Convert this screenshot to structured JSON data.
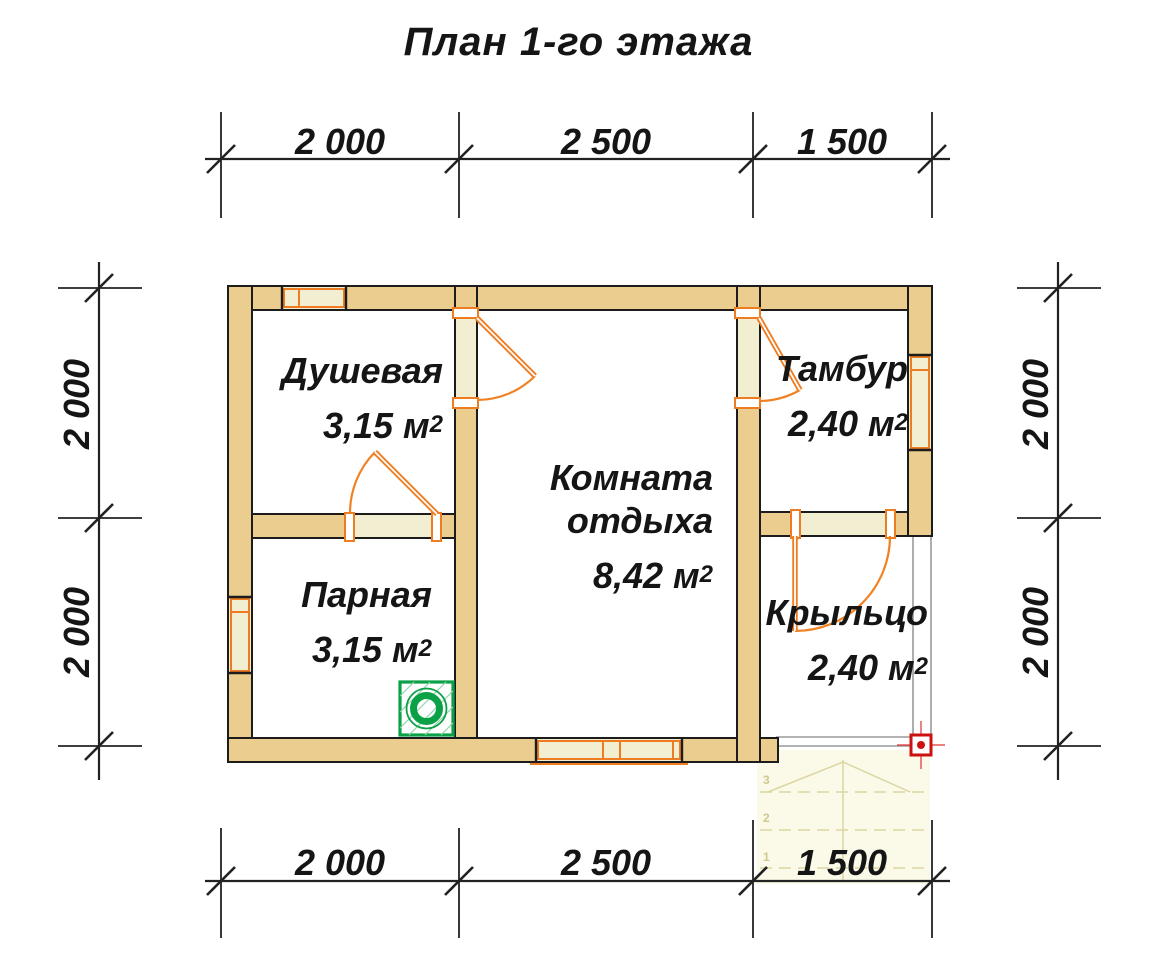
{
  "title": "План 1-го этажа",
  "dimensions": {
    "top": [
      "2 000",
      "2 500",
      "1 500"
    ],
    "bottom": [
      "2 000",
      "2 500",
      "1 500"
    ],
    "left": [
      "2 000",
      "2 000"
    ],
    "right": [
      "2 000",
      "2 000"
    ]
  },
  "rooms": {
    "dushevaya": {
      "name": "Душевая",
      "area": "3,15 м",
      "area_sup": "2"
    },
    "parnaya": {
      "name": "Парная",
      "area": "3,15 м",
      "area_sup": "2"
    },
    "komnata": {
      "name_line1": "Комната",
      "name_line2": "отдыха",
      "area": "8,42 м",
      "area_sup": "2"
    },
    "tambur": {
      "name": "Тамбур",
      "area": "2,40 м",
      "area_sup": "2"
    },
    "kryltso": {
      "name": "Крыльцо",
      "area": "2,40 м",
      "area_sup": "2"
    }
  },
  "porch_steps": {
    "s3": "3",
    "s2": "2",
    "s1": "1"
  },
  "colors": {
    "wall_fill": "#EBCE8F",
    "outline": "#1c1c1c",
    "opening_fill": "#F2EED2",
    "joinery_orange": "#EE7D22",
    "stove_green": "#0AA147",
    "column_red": "#CC1111",
    "porch_line_gray": "#9A9A9A",
    "steps_line": "#DBD6A2"
  }
}
